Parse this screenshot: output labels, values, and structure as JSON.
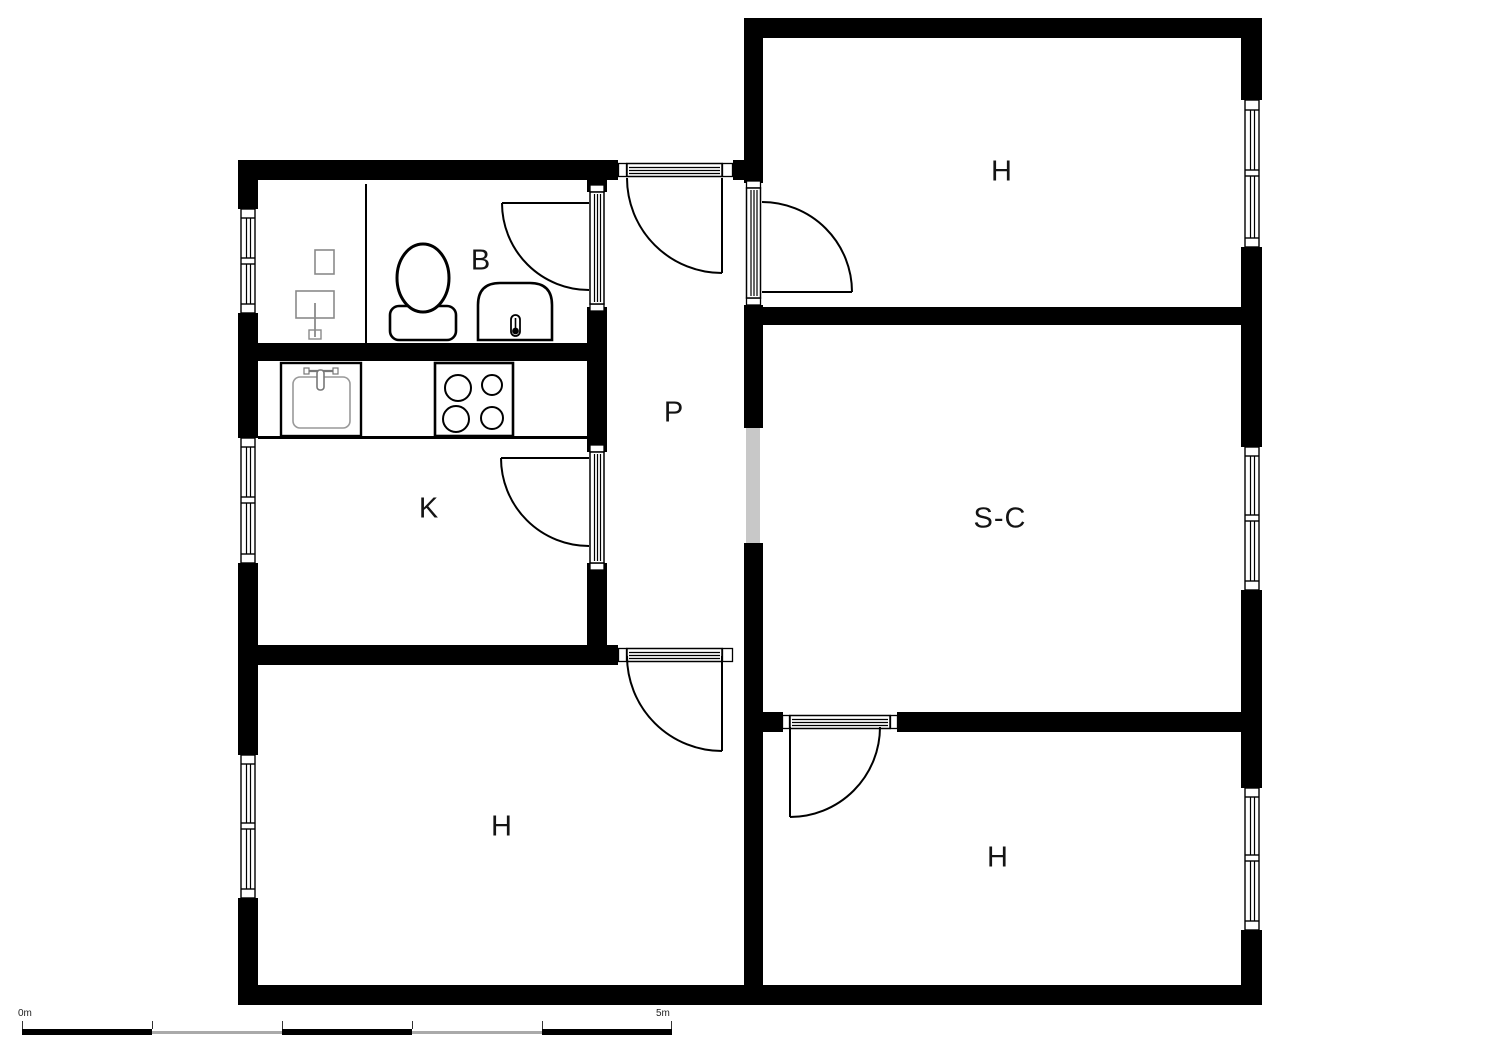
{
  "rooms": [
    {
      "id": "room-top-right",
      "label": "H"
    },
    {
      "id": "living-room",
      "label": "S-C"
    },
    {
      "id": "room-bottom-right",
      "label": "H"
    },
    {
      "id": "room-bottom-left",
      "label": "H"
    },
    {
      "id": "kitchen",
      "label": "K"
    },
    {
      "id": "bathroom",
      "label": "B"
    },
    {
      "id": "hallway",
      "label": "P"
    }
  ],
  "scale_bar": {
    "start_label": "0m",
    "end_label": "5m"
  },
  "fixtures": [
    "toilet",
    "water-heater",
    "washbasin",
    "kitchen-sink",
    "stove"
  ],
  "colors": {
    "wall": "#000000",
    "passage_opening": "#c8c8c8",
    "fixture_gray": "#8a8a8a",
    "background": "#ffffff"
  }
}
